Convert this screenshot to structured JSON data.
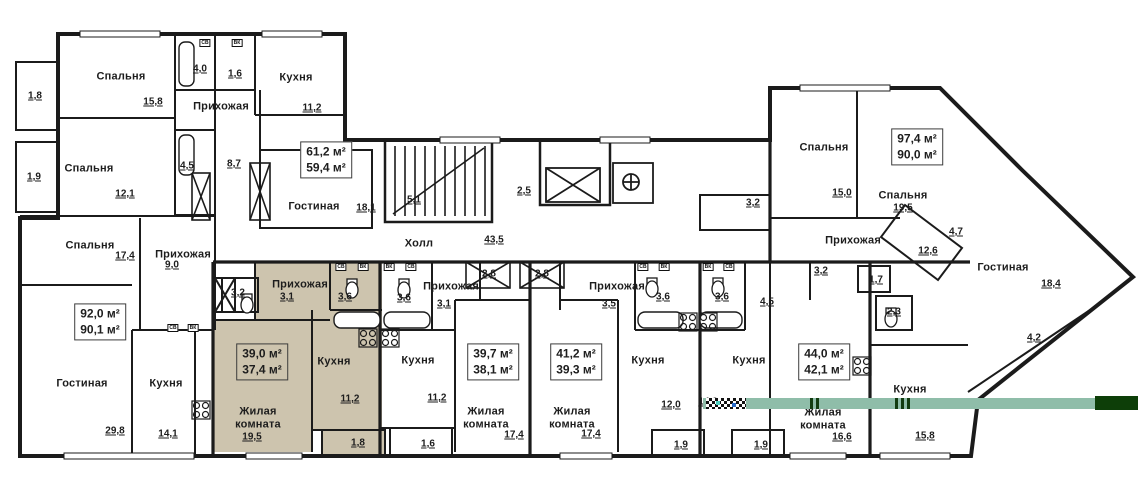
{
  "plan_title": "Floor plan with apartment areas",
  "colors": {
    "highlight_fill": "#cdc4ae",
    "wall": "#1b1b1b",
    "overlay_bar_light": "#8fbda9",
    "overlay_bar_dark": "#0d3e08"
  },
  "hall": {
    "label": "Холл",
    "area": "43,5"
  },
  "area_boxes": [
    {
      "total": "61,2 м²",
      "living": "59,4 м²",
      "cx": 326,
      "cy": 160,
      "highlighted": false
    },
    {
      "total": "92,0 м²",
      "living": "90,1 м²",
      "cx": 100,
      "cy": 322,
      "highlighted": false
    },
    {
      "total": "39,0 м²",
      "living": "37,4 м²",
      "cx": 262,
      "cy": 362,
      "highlighted": true
    },
    {
      "total": "39,7 м²",
      "living": "38,1 м²",
      "cx": 493,
      "cy": 362,
      "highlighted": false
    },
    {
      "total": "41,2 м²",
      "living": "39,3 м²",
      "cx": 576,
      "cy": 362,
      "highlighted": false
    },
    {
      "total": "44,0 м²",
      "living": "42,1 м²",
      "cx": 824,
      "cy": 362,
      "highlighted": false
    },
    {
      "total": "97,4 м²",
      "living": "90,0 м²",
      "cx": 917,
      "cy": 147,
      "highlighted": false
    }
  ],
  "room_labels": [
    [
      "Спальня",
      121,
      77
    ],
    [
      "Кухня",
      296,
      78
    ],
    [
      "Прихожая",
      221,
      107
    ],
    [
      "Спальня",
      89,
      169
    ],
    [
      "Гостиная",
      314,
      207
    ],
    [
      "Спальня",
      90,
      246
    ],
    [
      "Прихожая",
      183,
      255
    ],
    [
      "Гостиная",
      82,
      384
    ],
    [
      "Кухня",
      166,
      384
    ],
    [
      "Прихожая",
      300,
      285
    ],
    [
      "Жилая комната",
      258,
      418,
      64
    ],
    [
      "Кухня",
      334,
      362
    ],
    [
      "Прихожая",
      451,
      287
    ],
    [
      "Кухня",
      418,
      361
    ],
    [
      "Жилая комната",
      486,
      418,
      64
    ],
    [
      "Прихожая",
      617,
      287
    ],
    [
      "Жилая комната",
      572,
      418,
      64
    ],
    [
      "Кухня",
      648,
      361
    ],
    [
      "Кухня",
      749,
      361
    ],
    [
      "Жилая комната",
      823,
      419,
      64
    ],
    [
      "Спальня",
      824,
      148
    ],
    [
      "Спальня",
      903,
      196
    ],
    [
      "Прихожая",
      853,
      241
    ],
    [
      "Гостиная",
      1003,
      268
    ],
    [
      "Кухня",
      910,
      390
    ],
    [
      "Холл",
      419,
      244
    ]
  ],
  "area_values": [
    [
      "15,8",
      153,
      102
    ],
    [
      "1,8",
      35,
      96
    ],
    [
      "11,2",
      312,
      108
    ],
    [
      "4,0",
      200,
      69
    ],
    [
      "1,6",
      235,
      74
    ],
    [
      "8,7",
      234,
      164
    ],
    [
      "12,1",
      125,
      194
    ],
    [
      "1,9",
      34,
      177
    ],
    [
      "4,5",
      187,
      166
    ],
    [
      "18,1",
      366,
      208
    ],
    [
      "17,4",
      125,
      256
    ],
    [
      "9,0",
      172,
      265
    ],
    [
      "29,8",
      115,
      431
    ],
    [
      "14,1",
      168,
      434
    ],
    [
      "3,2",
      238,
      293
    ],
    [
      "3,1",
      287,
      297
    ],
    [
      "3,6",
      345,
      297
    ],
    [
      "19,5",
      252,
      437
    ],
    [
      "11,2",
      350,
      399
    ],
    [
      "1,8",
      358,
      443
    ],
    [
      "3,6",
      404,
      298
    ],
    [
      "3,1",
      444,
      304
    ],
    [
      "2,8",
      489,
      274
    ],
    [
      "11,2",
      437,
      398
    ],
    [
      "17,4",
      514,
      435
    ],
    [
      "1,6",
      428,
      444
    ],
    [
      "2,8",
      542,
      274
    ],
    [
      "3,5",
      609,
      304
    ],
    [
      "3,6",
      663,
      297
    ],
    [
      "17,4",
      591,
      434
    ],
    [
      "12,0",
      671,
      405
    ],
    [
      "1,9",
      681,
      445
    ],
    [
      "3,6",
      722,
      297
    ],
    [
      "4,5",
      767,
      302
    ],
    [
      "3,2",
      821,
      271
    ],
    [
      "1,7",
      876,
      280
    ],
    [
      "2,3",
      894,
      312
    ],
    [
      "14,2",
      708,
      402
    ],
    [
      "16,6",
      842,
      437
    ],
    [
      "1,9",
      761,
      445
    ],
    [
      "15,0",
      842,
      193
    ],
    [
      "19,5",
      903,
      208
    ],
    [
      "3,2",
      753,
      203
    ],
    [
      "12,6",
      928,
      251
    ],
    [
      "4,7",
      956,
      232
    ],
    [
      "18,4",
      1051,
      284
    ],
    [
      "4,2",
      1034,
      338
    ],
    [
      "15,8",
      925,
      436
    ],
    [
      "43,5",
      494,
      240
    ],
    [
      "5,1",
      414,
      200
    ],
    [
      "2,5",
      524,
      191
    ]
  ],
  "fixture_tags": [
    [
      "СВ",
      205,
      43
    ],
    [
      "ВК",
      237,
      43
    ],
    [
      "СВ",
      173,
      328
    ],
    [
      "ВК",
      193,
      328
    ],
    [
      "СВ",
      341,
      267
    ],
    [
      "ВК",
      363,
      267
    ],
    [
      "ВК",
      389,
      267
    ],
    [
      "СВ",
      411,
      267
    ],
    [
      "СВ",
      643,
      267
    ],
    [
      "ВК",
      664,
      267
    ],
    [
      "ВК",
      708,
      267
    ],
    [
      "СВ",
      729,
      267
    ]
  ]
}
